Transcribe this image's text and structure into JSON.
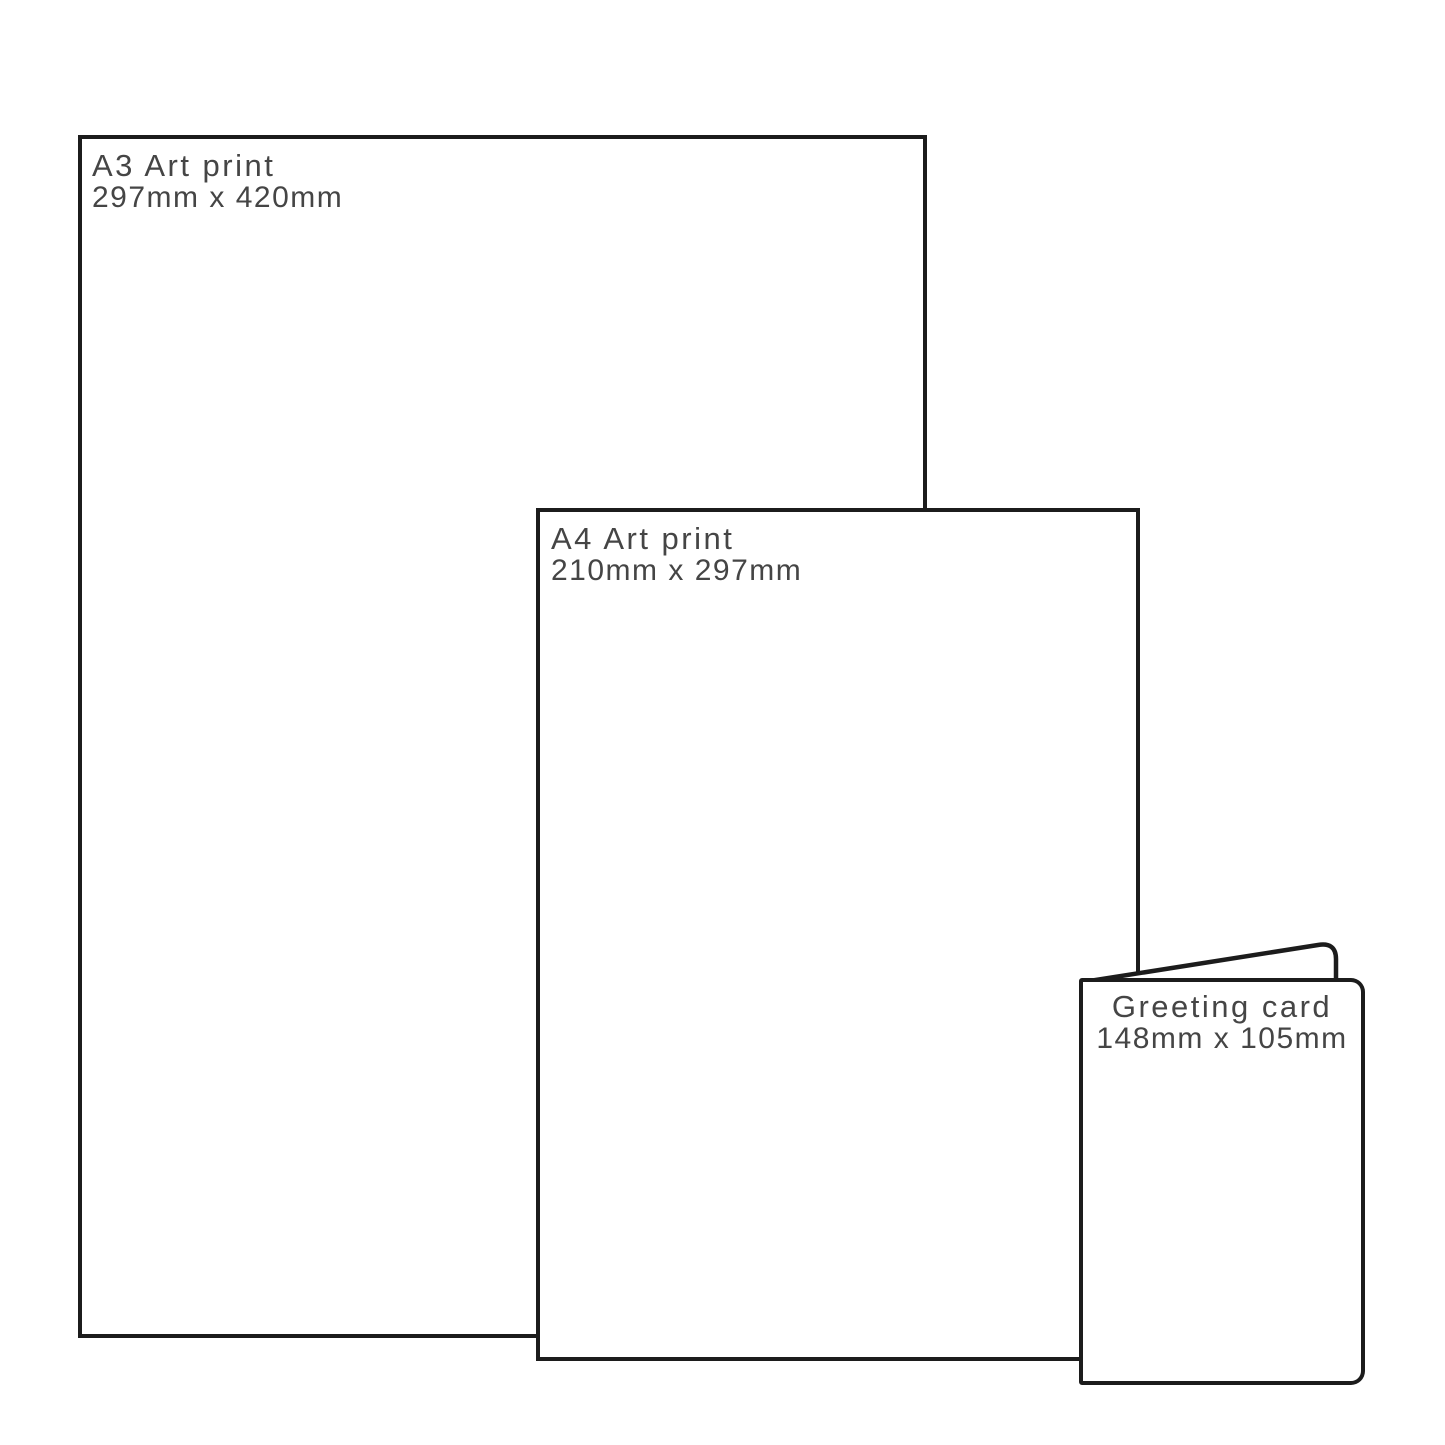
{
  "theme": {
    "background": "#ffffff",
    "outline_color": "#1c1c1c",
    "text_color": "#454545"
  },
  "sizes": [
    {
      "name": "A3 Art print",
      "dimensions": "297mm x 420mm"
    },
    {
      "name": "A4 Art print",
      "dimensions": "210mm x 297mm"
    },
    {
      "name": "Greeting card",
      "dimensions": "148mm x 105mm"
    }
  ]
}
